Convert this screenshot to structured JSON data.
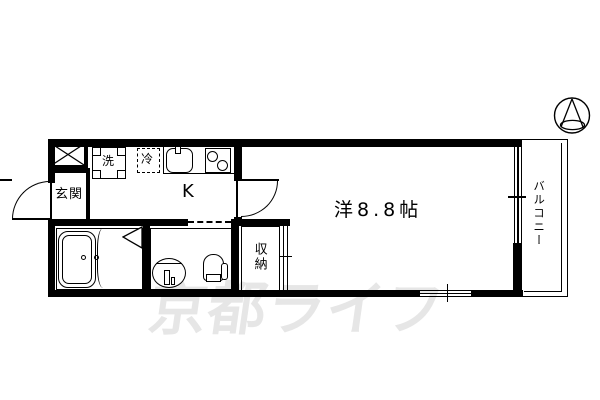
{
  "plan": {
    "type": "apartment-floorplan",
    "labels": {
      "entrance": "玄関",
      "washer": "洗",
      "fridge": "冷",
      "kitchen": "K",
      "main_room": "洋8.8帖",
      "storage": "収納",
      "balcony": "バルコニー"
    },
    "watermark": {
      "text": "京都ライフ",
      "color": "#e6e6e6"
    },
    "colors": {
      "line": "#000000",
      "background": "#ffffff"
    },
    "icons": [
      "compass-north-icon",
      "shaft-x-icon",
      "bathroom-door-triangle-icon"
    ]
  }
}
